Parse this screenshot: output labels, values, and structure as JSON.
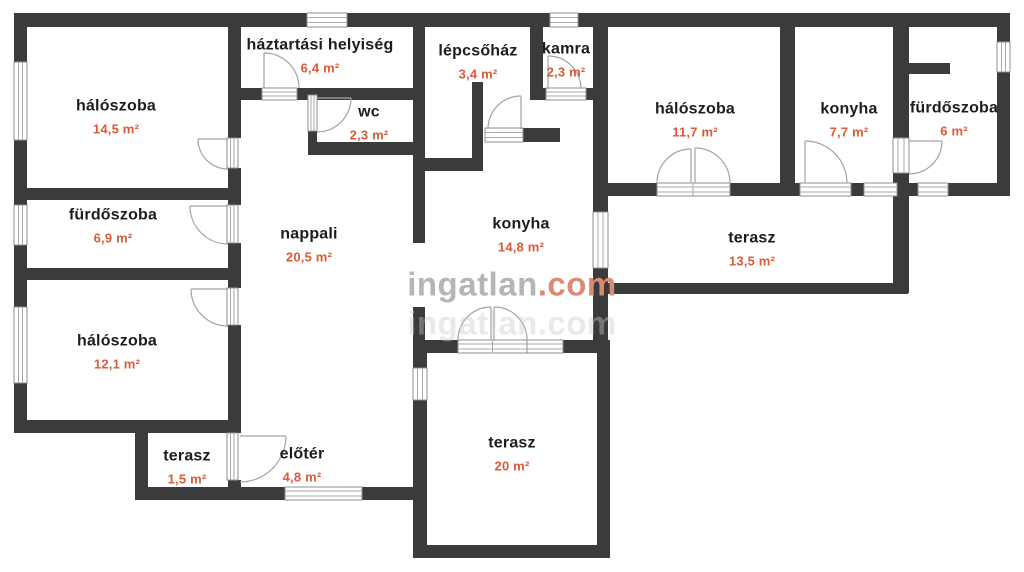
{
  "watermark": {
    "prefix": "ingatlan",
    "suffix": ".com"
  },
  "colors": {
    "wall": "#3b3b3b",
    "room_name_text": "#1d1d1d",
    "room_area_text": "#d95b38",
    "watermark_gray": "#b5b5b5",
    "watermark_orange": "#da8b73",
    "door_arc": "#a3a3a3",
    "window_frame": "#8f8f8f"
  },
  "rooms": [
    {
      "id": "haloszoba-1",
      "name": "hálószoba",
      "area": "14,5 m²"
    },
    {
      "id": "furdoszoba-1",
      "name": "fürdőszoba",
      "area": "6,9 m²"
    },
    {
      "id": "haloszoba-2",
      "name": "hálószoba",
      "area": "12,1 m²"
    },
    {
      "id": "terasz-1",
      "name": "terasz",
      "area": "1,5 m²"
    },
    {
      "id": "haztartasi",
      "name": "háztartási helyiség",
      "area": "6,4 m²"
    },
    {
      "id": "wc",
      "name": "wc",
      "area": "2,3 m²"
    },
    {
      "id": "lepcsohaz",
      "name": "lépcsőház",
      "area": "3,4 m²"
    },
    {
      "id": "kamra",
      "name": "kamra",
      "area": "2,3 m²"
    },
    {
      "id": "nappali",
      "name": "nappali",
      "area": "20,5 m²"
    },
    {
      "id": "konyha-1",
      "name": "konyha",
      "area": "14,8 m²"
    },
    {
      "id": "eloter",
      "name": "előtér",
      "area": "4,8 m²"
    },
    {
      "id": "terasz-2",
      "name": "terasz",
      "area": "20 m²"
    },
    {
      "id": "haloszoba-3",
      "name": "hálószoba",
      "area": "11,7 m²"
    },
    {
      "id": "konyha-2",
      "name": "konyha",
      "area": "7,7 m²"
    },
    {
      "id": "furdoszoba-2",
      "name": "fürdőszoba",
      "area": "6 m²"
    },
    {
      "id": "terasz-3",
      "name": "terasz",
      "area": "13,5 m²"
    }
  ]
}
